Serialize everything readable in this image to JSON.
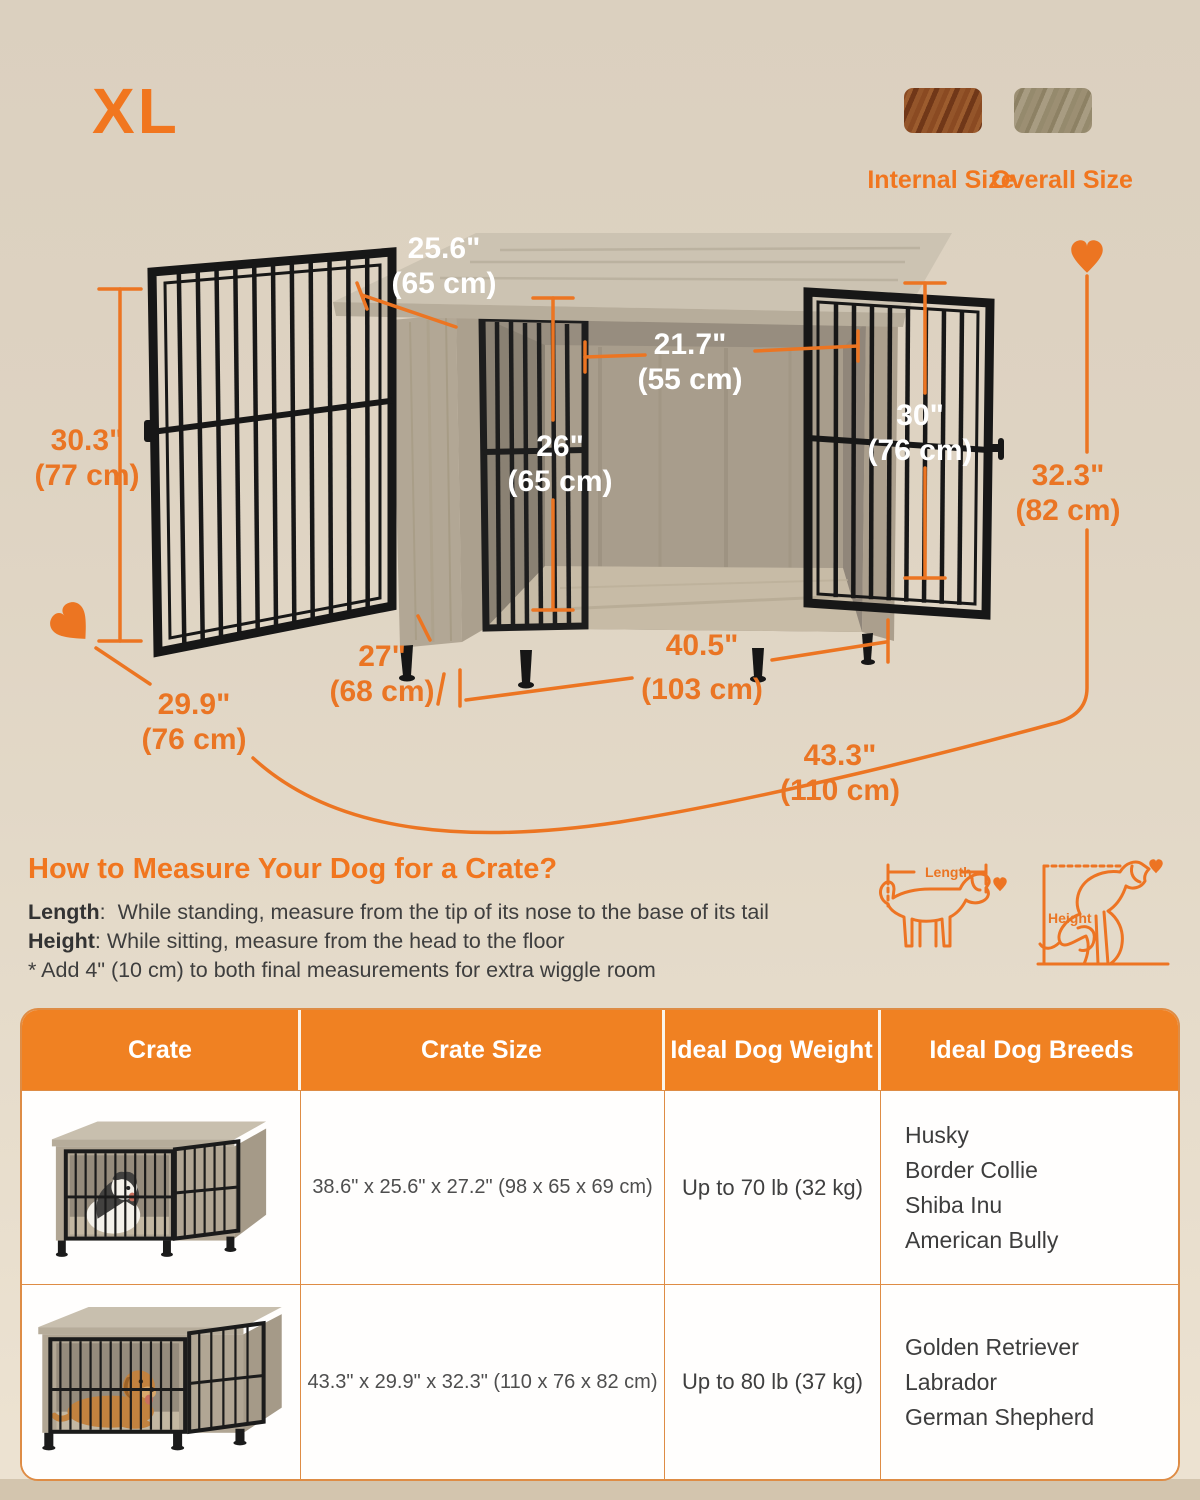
{
  "size_label": "XL",
  "legend": {
    "internal_label": "Internal Size",
    "overall_label": "Overall Size"
  },
  "dims": {
    "top_depth": {
      "in": "25.6\"",
      "cm": "(65 cm)"
    },
    "door_width": {
      "in": "21.7\"",
      "cm": "(55 cm)"
    },
    "front_height": {
      "in": "26\"",
      "cm": "(65 cm)"
    },
    "right_door_height": {
      "in": "30\"",
      "cm": "(76 cm)"
    },
    "left_door_height": {
      "in": "30.3\"",
      "cm": "(77 cm)"
    },
    "overall_height": {
      "in": "32.3\"",
      "cm": "(82 cm)"
    },
    "base_depth": {
      "in": "27\"",
      "cm": "(68 cm)"
    },
    "interior_width": {
      "in": "40.5\"",
      "cm": "(103 cm)"
    },
    "overall_depth": {
      "in": "29.9\"",
      "cm": "(76 cm)"
    },
    "overall_width": {
      "in": "43.3\"",
      "cm": "(110 cm)"
    }
  },
  "measure_guide": {
    "title": "How to Measure Your Dog for a Crate?",
    "length_label": "Length",
    "length_text": ":  While standing, measure from the tip of its nose to the base of its tail",
    "height_label": "Height",
    "height_text": ": While sitting, measure from the head to the floor",
    "note": "* Add 4\" (10 cm) to both final measurements for extra wiggle room",
    "diagram_length_label": "Length",
    "diagram_height_label": "Height"
  },
  "table": {
    "headers": [
      "Crate",
      "Crate Size",
      "Ideal Dog Weight",
      "Ideal Dog Breeds"
    ],
    "rows": [
      {
        "size": "38.6\" x 25.6\" x 27.2\" (98 x 65 x 69 cm)",
        "weight": "Up to 70 lb (32 kg)",
        "breeds": [
          "Husky",
          "Border Collie",
          "Shiba Inu",
          "American Bully"
        ]
      },
      {
        "size": "43.3\" x 29.9\" x 32.3\" (110 x 76 x 82 cm)",
        "weight": "Up to 80 lb (37 kg)",
        "breeds": [
          "Golden Retriever",
          "Labrador",
          "German Shepherd"
        ]
      }
    ]
  },
  "colors": {
    "accent": "#EC7522",
    "table_header": "#F08122",
    "dim_text_light": "#FFFFFF",
    "background": "#E0D5C4",
    "wood": "#B3A896",
    "metal": "#1B1B1B"
  }
}
